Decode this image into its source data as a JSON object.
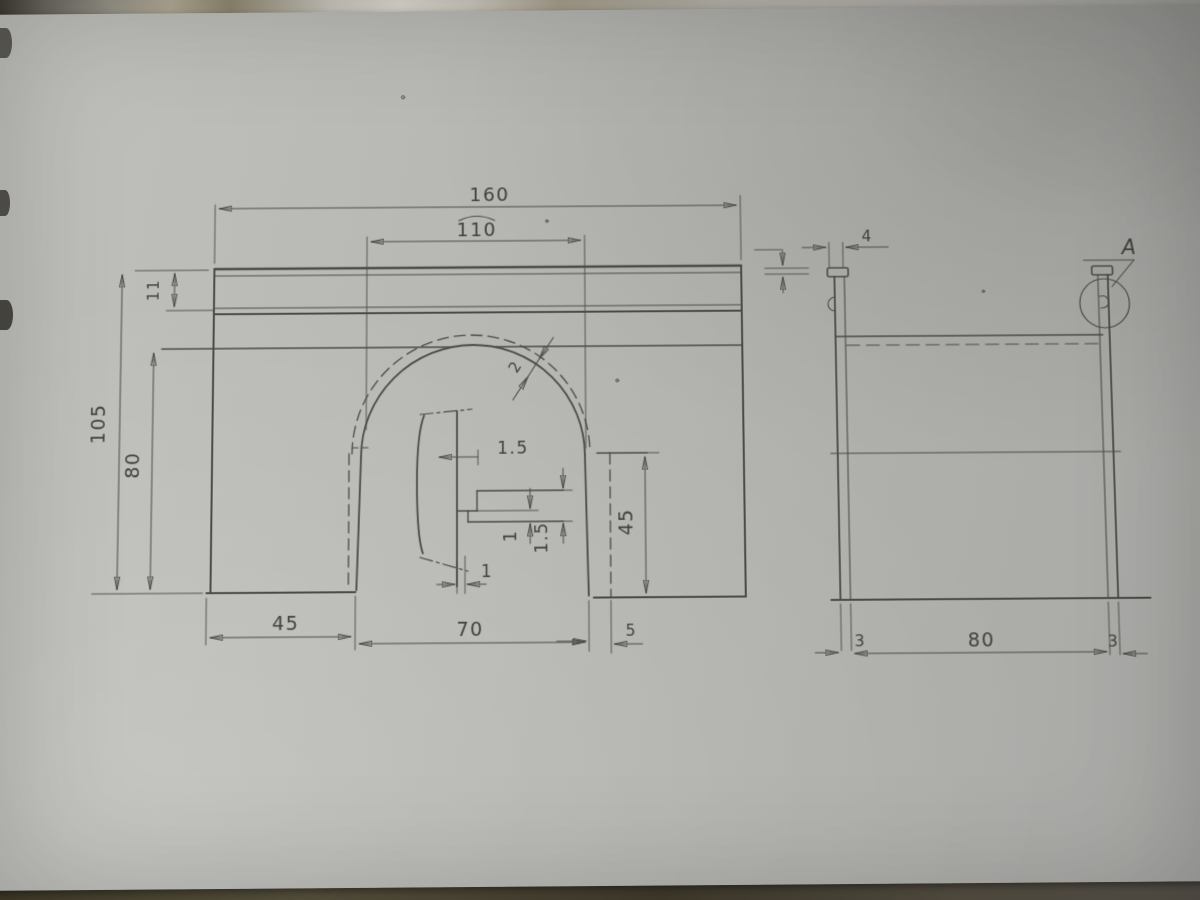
{
  "drawing": {
    "front": {
      "dim_overall_width": "160",
      "dim_arc_length": "110",
      "dim_total_height": "105",
      "dim_body_height": "80",
      "dim_top_band": "11",
      "dim_left_leg": "45",
      "dim_arch_width": "70",
      "dim_edge_offset": "5",
      "dim_shoulder_height": "45",
      "dim_arc_gap": "2",
      "dim_step_top": "1.5",
      "dim_step_right_a": "1.5",
      "dim_step_right_b": "1",
      "dim_step_bottom": "1"
    },
    "side": {
      "dim_cap_width": "4",
      "dim_wall_left": "3",
      "dim_inner_width": "80",
      "dim_wall_right": "3",
      "detail_label": "A"
    }
  },
  "colors": {
    "paper": "#b6b6b2",
    "ink": "#45443f",
    "table_dark": "#453f2c",
    "table_light": "#ddd9d1"
  }
}
